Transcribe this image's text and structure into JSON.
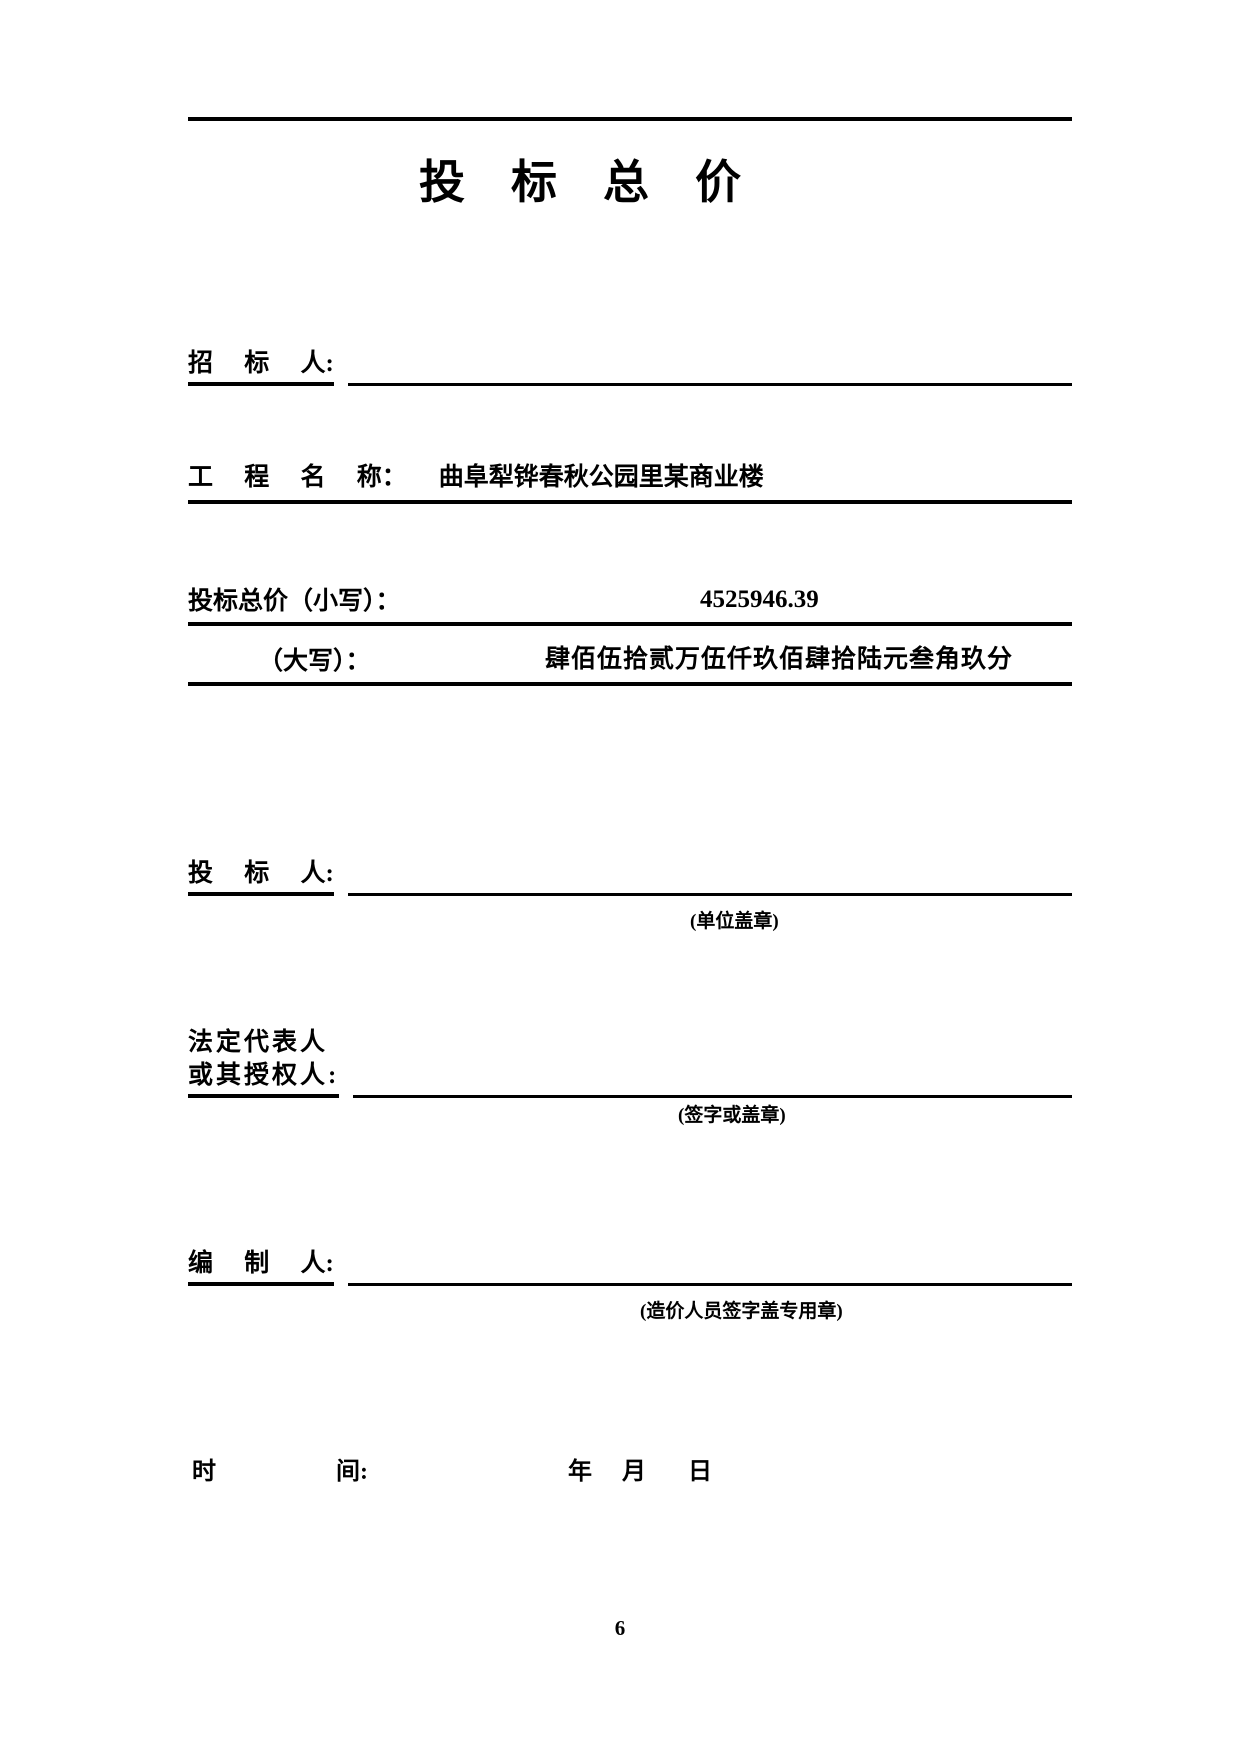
{
  "page": {
    "title": "投    标    总    价",
    "page_number": "6"
  },
  "rows": {
    "tenderee": {
      "label": "招     标     人:"
    },
    "project": {
      "label": "工     程     名     称：",
      "value": "曲阜犁铧春秋公园里某商业楼"
    },
    "price_figures": {
      "label": "投标总价（小写）：",
      "value": "4525946.39"
    },
    "price_words": {
      "label": "（大写）：",
      "value": "肆佰伍拾贰万伍仟玖佰肆拾陆元叁角玖分"
    },
    "bidder": {
      "label": "投     标     人:",
      "note": "(单位盖章)"
    },
    "legal_representative": {
      "label_line1": "法定代表人",
      "label_line2": "或其授权人:",
      "note": "(签字或盖章)"
    },
    "preparer": {
      "label": "编     制     人:",
      "note": "(造价人员签字盖专用章)"
    },
    "time": {
      "label": "时                    间:",
      "value": "年     月       日"
    }
  }
}
